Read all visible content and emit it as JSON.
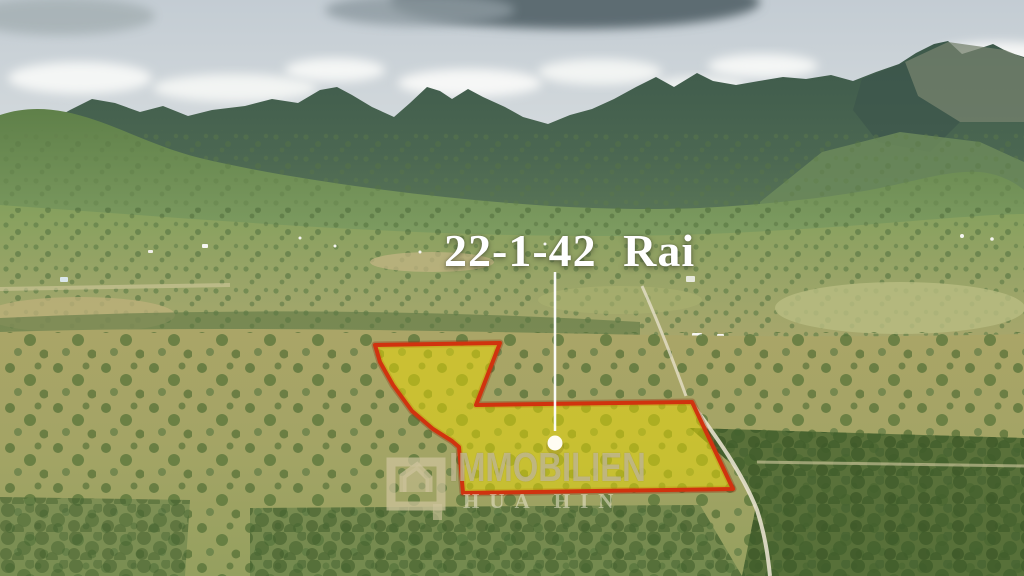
{
  "overlay": {
    "area_label": "22-1-42 Rai",
    "plot_fill_color": "#EDDC00",
    "plot_outline_color": "#D0330F",
    "pointer_color": "#FFFFFF"
  },
  "watermark": {
    "brand": "IMMOBILIEN",
    "location": "HUA HIN",
    "logo": "house-outline-icon"
  },
  "scene_colors": {
    "sky": "#C9D2D8",
    "storm_cloud": "#5D6C72",
    "mountains": "#415E4C",
    "hills": "#67884F",
    "valley": "#8AA55F",
    "field_ground": "#B1AA6B",
    "palm_canopy": "#4D6B33"
  }
}
